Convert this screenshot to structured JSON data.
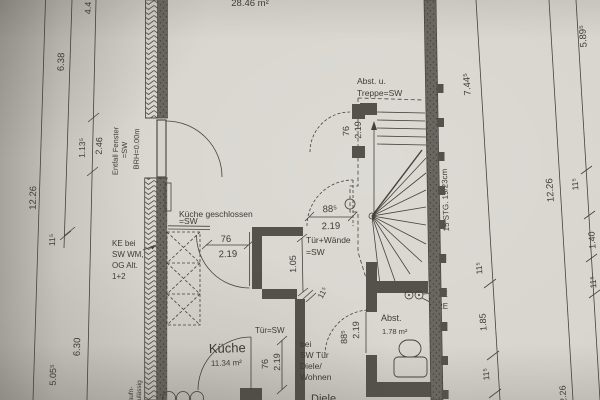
{
  "document_type": "floor-plan-photo",
  "labels": {
    "area_main": "28.46 m²",
    "kueche": "Küche",
    "kueche_area": "11.34 m²",
    "abst": "Abst.",
    "abst_area": "1.78 m²",
    "diele": "Diele",
    "kg1": "Küche geschlossen",
    "kg2": "=SW",
    "tw1": "Tür+Wände",
    "tw2": "=SW",
    "tsw": "Tür=SW",
    "bs1": "bei",
    "bs2": "SW Tür",
    "bs3": "Diele/",
    "bs4": "Wohnen",
    "tr1": "Abst. u.",
    "tr2": "Treppe=SW",
    "stg": "15 STG. 19/23cm",
    "ke1": "KE bei",
    "ke2": "SW WM,",
    "ke3": "OG Alt.",
    "ke4": "1+2",
    "ke": "KE",
    "re": "RE",
    "ef1": "Entfall Fenster",
    "ef2": "=SW",
    "brh": "BRH=0.00m",
    "en1": "aufn-",
    "en2": "zulässig"
  },
  "dims": {
    "l44": "4.4",
    "l638": "6.38",
    "l1226": "12.26",
    "l1135": "1.13⁵",
    "l246": "2.46",
    "l115": "11⁵",
    "l630": "6.30",
    "l5055": "5.05⁵",
    "r7445": "7.44⁵",
    "r5895": "5.89⁵",
    "r1226": "12.26",
    "r115a": "11⁵",
    "r140": "1.40",
    "r115b": "11⁵",
    "r185": "1.85",
    "r115c": "11⁵",
    "r115d": "11⁵",
    "r226": "2.26",
    "sd76": "76",
    "sd219": "2.19",
    "kt76": "76",
    "kt219": "2.19",
    "kb76": "76",
    "kb219": "2.19",
    "da88": "88⁵",
    "da219": "2.19",
    "db88": "88⁵",
    "db219": "2.19",
    "n105": "1.05",
    "n115": "11⁵"
  },
  "colors": {
    "paper": "#d6d3cc",
    "ink": "#45423d",
    "wall": "#55524c"
  }
}
